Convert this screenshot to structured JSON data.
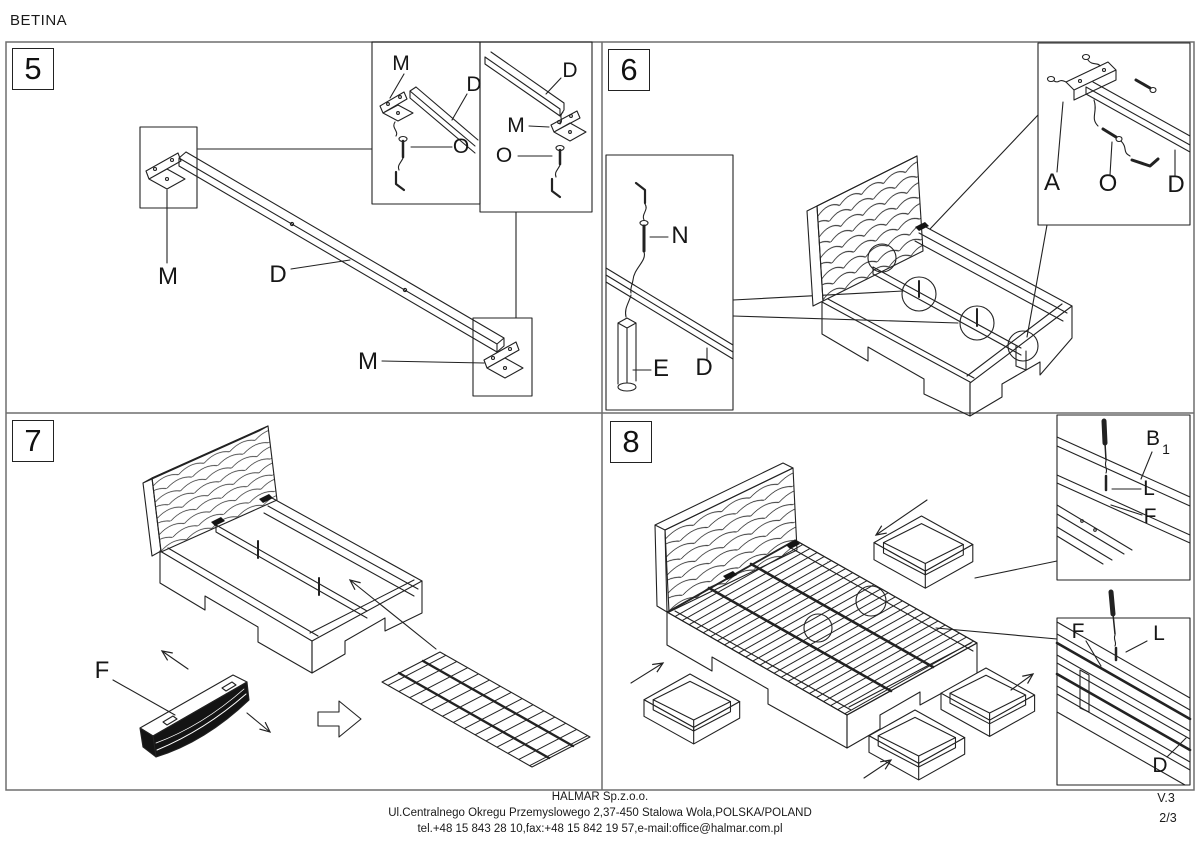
{
  "title": "BETINA",
  "panels": [
    {
      "number": "5",
      "labels": {
        "bracket_left": "M",
        "beam": "D",
        "bracket_right": "M",
        "inset1_bracket": "M",
        "inset1_beam": "D",
        "inset1_screw": "O",
        "inset2_beam": "D",
        "inset2_bracket": "M",
        "inset2_screw": "O"
      }
    },
    {
      "number": "6",
      "labels": {
        "screw": "N",
        "leg": "E",
        "beam": "D",
        "headboard": "A",
        "screw_o": "O",
        "beam_d": "D"
      }
    },
    {
      "number": "7",
      "labels": {
        "slat_pack": "F"
      }
    },
    {
      "number": "8",
      "labels": {
        "side_rail": "B",
        "side_rail_index": "1",
        "screw_top": "L",
        "slat_top": "F",
        "slat_bottom": "F",
        "screw_bottom": "L",
        "beam": "D"
      }
    }
  ],
  "footer": {
    "company": "HALMAR Sp.z.o.o.",
    "address": "Ul.Centralnego Okregu Przemyslowego 2,37-450 Stalowa Wola,POLSKA/POLAND",
    "contact": "tel.+48 15 843 28 10,fax:+48 15 842 19 57,e-mail:office@halmar.com.pl",
    "version": "V.3",
    "page": "2/3"
  },
  "colors": {
    "line": "#222222",
    "frame": "#6e6e6e",
    "dark_fill": "#141414"
  }
}
